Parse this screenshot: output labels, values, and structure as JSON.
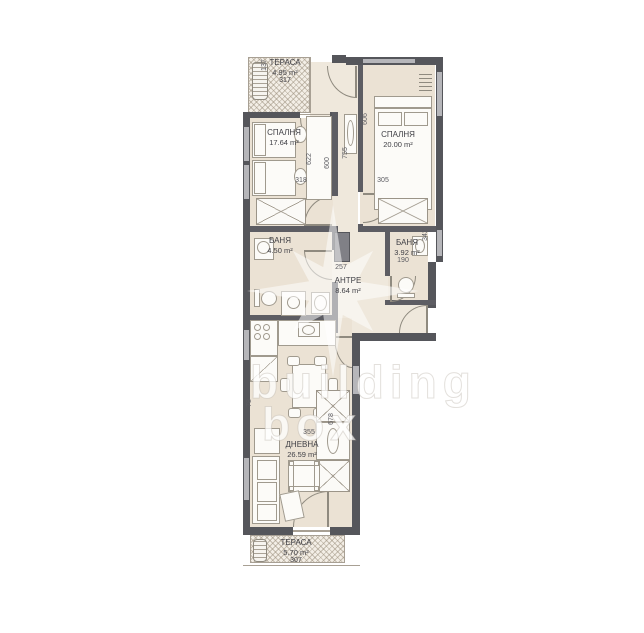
{
  "watermark": {
    "line1": "building",
    "line2": "box"
  },
  "rooms": {
    "terrace_top": {
      "name": "ТЕРАСА",
      "area": "4.95 m²",
      "number": "317"
    },
    "bedroom_left": {
      "name": "СПАЛНЯ",
      "area": "17.64 m²"
    },
    "bedroom_right": {
      "name": "СПАЛНЯ",
      "area": "20.00 m²"
    },
    "bath_left": {
      "name": "БАНЯ",
      "area": "4.50 m²"
    },
    "bath_right": {
      "name": "БАНЯ",
      "area": "3.92 m²"
    },
    "hall": {
      "name": "АНТРЕ",
      "area": "8.64 m²"
    },
    "living": {
      "name": "ДНЕВНА",
      "area": "26.59 m²"
    },
    "terrace_bottom": {
      "name": "ТЕРАСА",
      "area": "5.70 m²",
      "number": "307"
    }
  },
  "dimensions": {
    "terrace_top_height": "137",
    "bedroom_left_width": "318",
    "desk_left": "622",
    "desk_right": "600",
    "corridor_height": "755",
    "bedroom_right_height": "606",
    "bedroom_right_width": "305",
    "shaft_width": "257",
    "closet_right": "342",
    "bath_right_width": "190",
    "living_width": "355",
    "living_niche": "78",
    "living_height": "678"
  },
  "colors": {
    "wall": "#55565b",
    "floor": "#ebe2d4",
    "window": "#b6b6ba",
    "accent_line": "#a09a8e"
  }
}
